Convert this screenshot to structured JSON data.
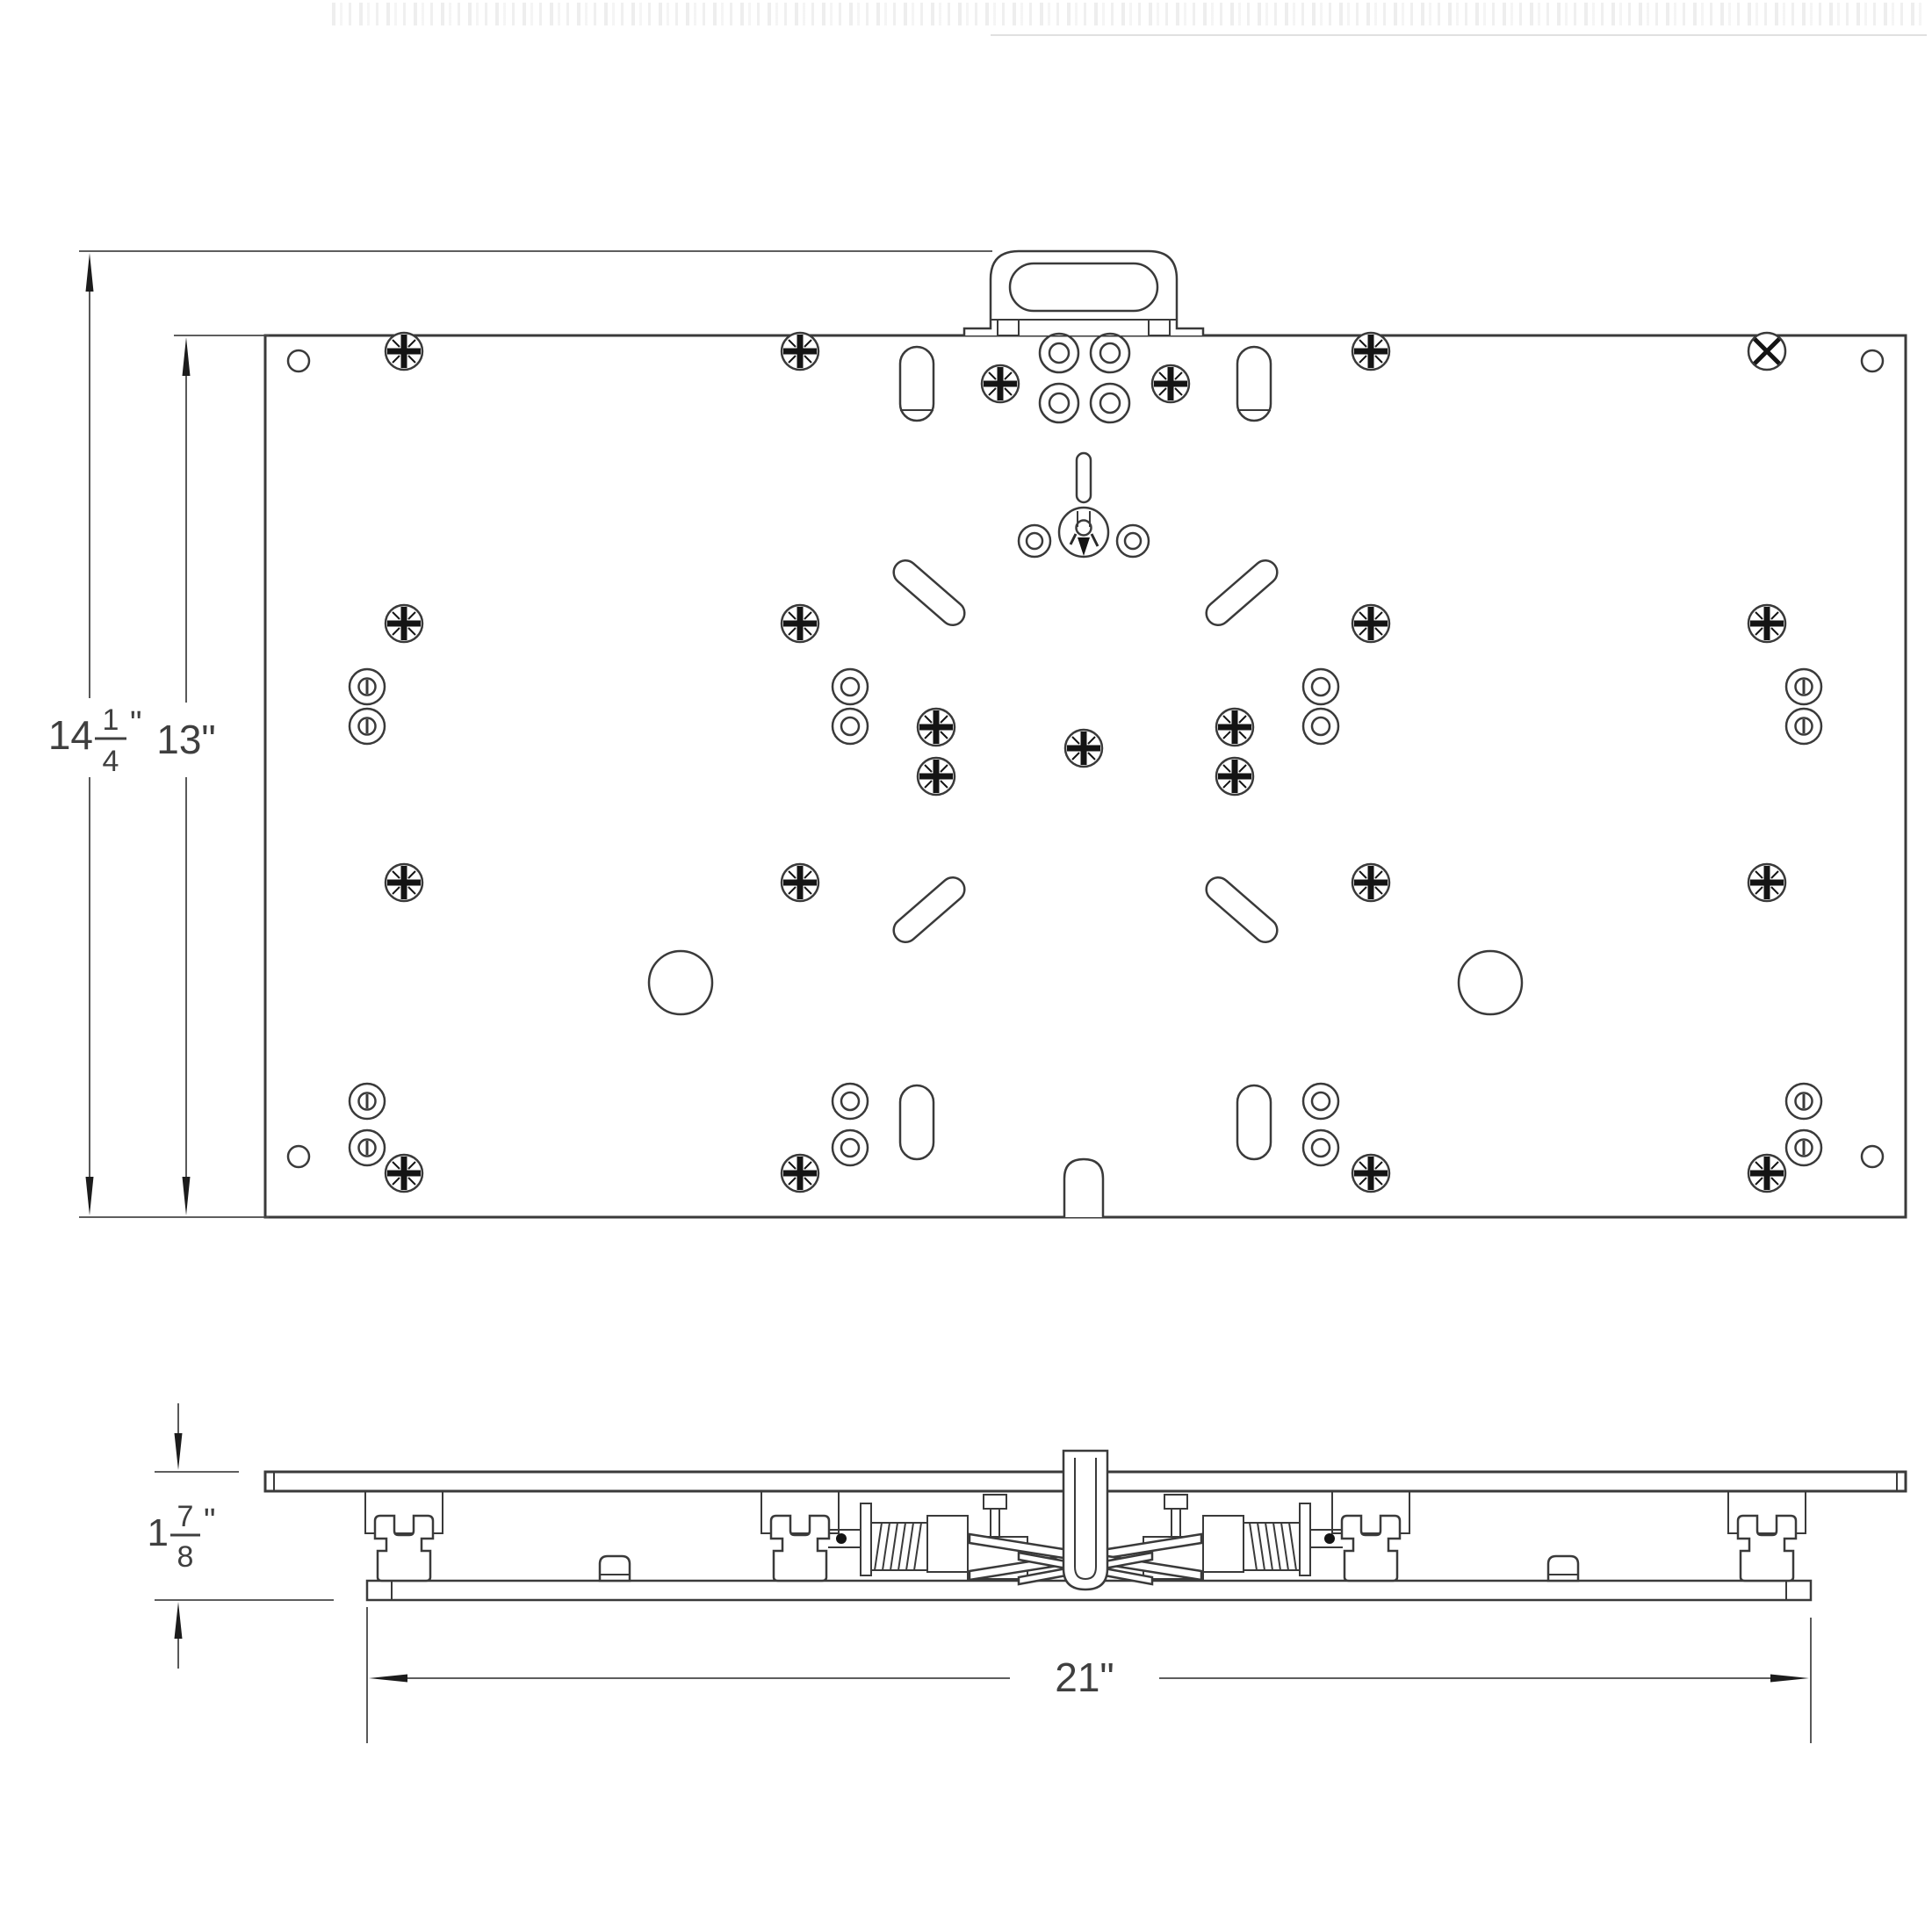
{
  "dimensions": {
    "overall_height": {
      "whole": "14",
      "numerator": "1",
      "denominator": "4",
      "unit": "\""
    },
    "plate_height": {
      "label": "13\""
    },
    "profile_height": {
      "whole": "1",
      "numerator": "7",
      "denominator": "8",
      "unit": "\""
    },
    "rail_length": {
      "label": "21\""
    }
  },
  "colors": {
    "background": "#ffffff",
    "line": "#3a3a3a",
    "dark_fill": "#141414",
    "dimension": "#474747",
    "watermark": "#ababab"
  }
}
